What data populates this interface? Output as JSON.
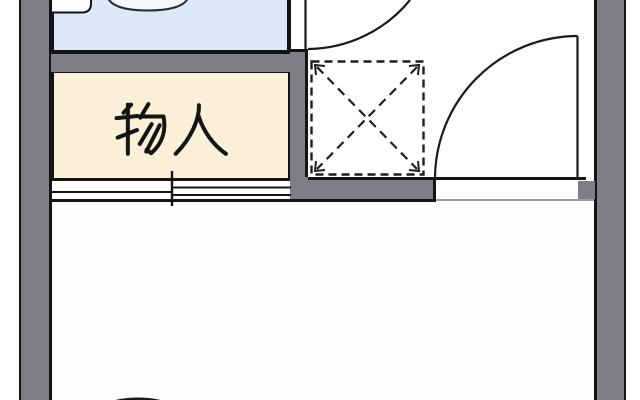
{
  "floorplan": {
    "storage_room": {
      "label": "物入"
    },
    "colors": {
      "wall_fill": "#7e7e86",
      "outline": "#141414",
      "bathroom_fill": "#dde9f8",
      "storage_fill": "#faf0d8",
      "room_fill": "#fefefe",
      "threshold_line": "#8f8f8f",
      "background": "#ffffff"
    },
    "symbols": {
      "sliding_door": "double-sliding-door-symbol",
      "hinged_door_top": "quarter-arc-swing-door",
      "hinged_door_right": "quarter-arc-swing-door",
      "dashed_x_box": "dashed-square-with-x-symbol",
      "bathroom_fixtures": "counter-and-basin-outline",
      "bottom_object": "dark-ellipse-partially-cropped"
    }
  }
}
